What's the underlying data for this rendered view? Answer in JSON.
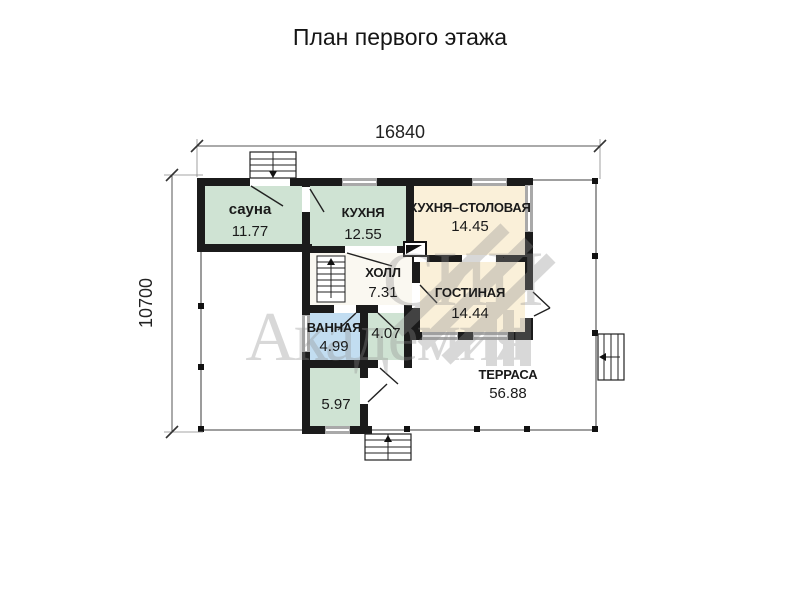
{
  "title": "План первого этажа",
  "dimensions": {
    "width": "16840",
    "height": "10700"
  },
  "rooms": {
    "sauna": {
      "name": "сауна",
      "area": "11.77"
    },
    "kitchen": {
      "name": "КУХНЯ",
      "area": "12.55"
    },
    "kitchen_dining": {
      "name": "КУХНЯ–СТОЛОВАЯ",
      "area": "14.45"
    },
    "hall": {
      "name": "ХОЛЛ",
      "area": "7.31"
    },
    "living": {
      "name": "ГОСТИНАЯ",
      "area": "14.44"
    },
    "bathroom": {
      "name": "ВАННАЯ",
      "area": "4.99"
    },
    "room_4_07": {
      "area": "4.07"
    },
    "room_5_97": {
      "area": "5.97"
    },
    "terrace": {
      "name": "ТЕРРАСА",
      "area": "56.88"
    }
  },
  "watermark": {
    "word1": "СИП",
    "word2": "Академия",
    "color": "#8f8f8f"
  },
  "colors": {
    "wall": "#1b1b1b",
    "room_green": "#cfe3d3",
    "room_cream": "#faf0d9",
    "room_blue": "#c2ddf1",
    "room_white": "#faf8f1",
    "window_fill": "#a9a9a9"
  }
}
